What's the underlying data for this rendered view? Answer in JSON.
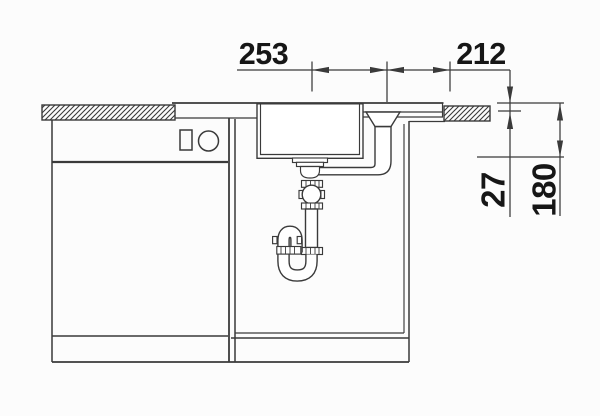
{
  "drawing": {
    "type": "sink-installation-cross-section",
    "dimensions": {
      "span_left": "253",
      "span_right": "212",
      "depth_small": "27",
      "depth_large": "180"
    },
    "colors": {
      "background": "#fcfcfc",
      "line": "#3a3a3a",
      "text": "#161616"
    }
  }
}
